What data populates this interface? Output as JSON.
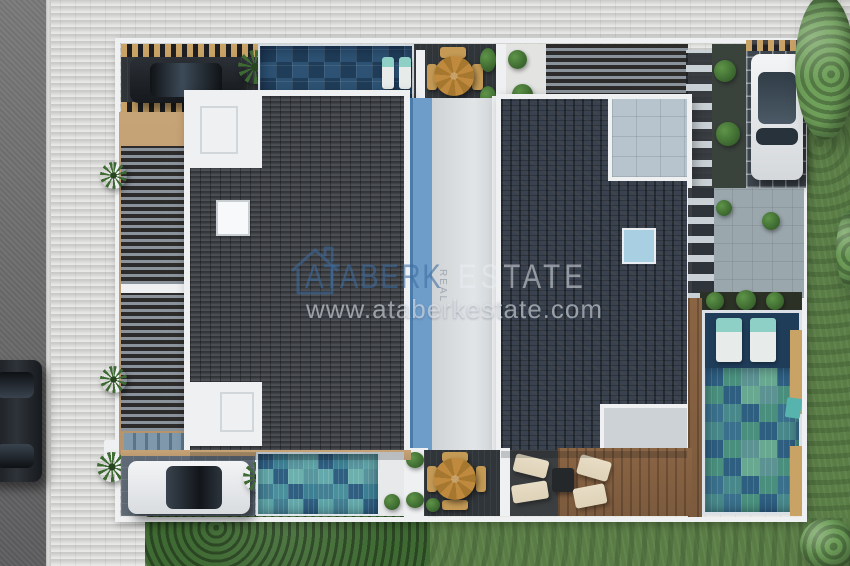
{
  "watermark": {
    "brand_primary": "ATABERK",
    "brand_vertical": "REAL",
    "brand_secondary": "ESTATE",
    "website": "www.ataberkestate.com",
    "logo": "house-outline-icon"
  },
  "scene": {
    "type": "aerial-architectural-rendering",
    "subject": "top-down view of twin villas with dark tiled roofs, four pools, roof terraces, pergolas, parked cars, gardens and street"
  },
  "colors": {
    "road": "#6f6f6f",
    "curb": "#dcdcda",
    "paver": "#d5d5d3",
    "wall": "#eef0f2",
    "tan": "#b5946c",
    "roof1": "#404449",
    "roof2": "#39424e",
    "strip_gray": "#d9dcdf",
    "strip_blue": "#6f9dca",
    "pool_navy": "#1f3c58",
    "pool_navy2": "#2d5273",
    "pool_teal": "#3d8094",
    "pool_teal2": "#63a8aa",
    "pool_green": "#4a8f7e",
    "pool_blue": "#2e5e80",
    "deck_dark": "#303539",
    "deck_wood": "#7c5a3d",
    "table_wood": "#c08a3e",
    "lounger": "#ded3b8",
    "slat": "#8a929c",
    "trellis_wood": "#c9a266",
    "stone": "#b7c4cd",
    "skylight": "#a9cfe2",
    "grass": "#5a7d46",
    "hedge": "#3f6a33",
    "tree": "#6fa05a",
    "tree_dark": "#4c7540",
    "plant": "#3e6b34",
    "car_dark": "#23272c",
    "car_white": "#e9ebed",
    "glass": "#2b353f",
    "wm_blue": "#3e6ca0",
    "wm_light": "#e9eef3"
  }
}
